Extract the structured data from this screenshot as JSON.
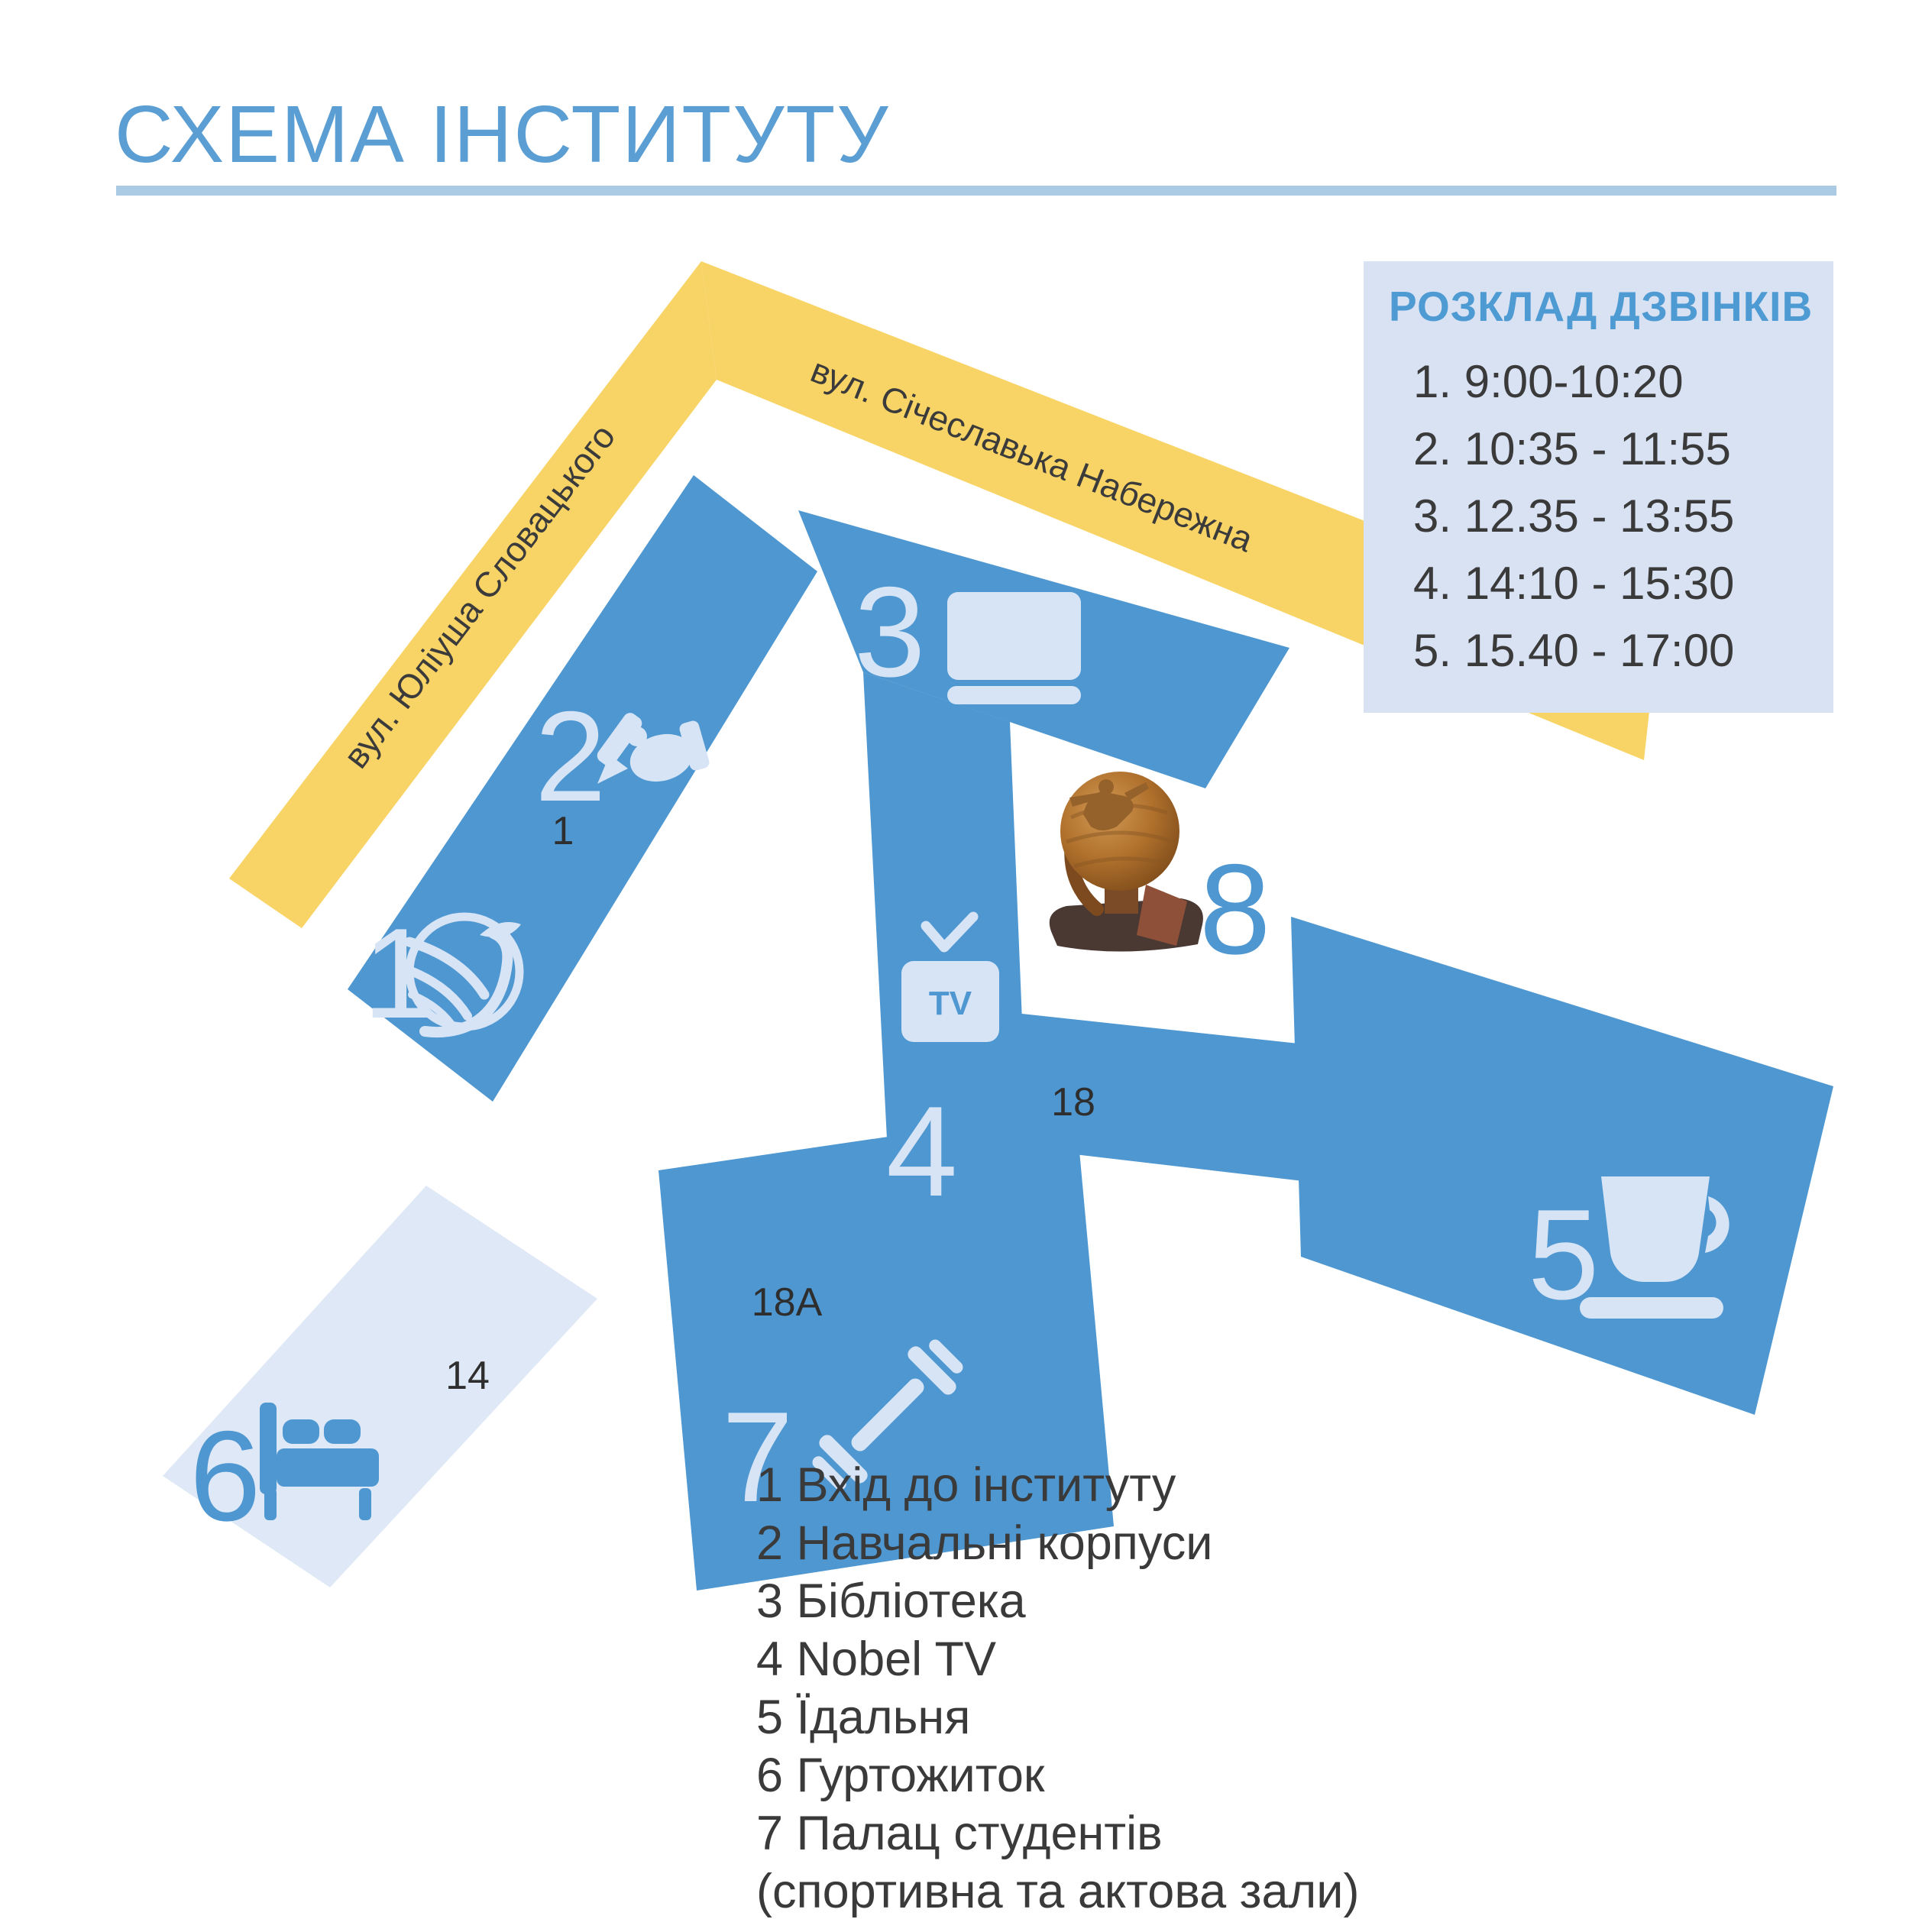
{
  "header": {
    "title": "СХЕМА ІНСТИТУТУ"
  },
  "streets": [
    {
      "name": "вул. Юліуша Словацького"
    },
    {
      "name": "вул. Січеславька Набережна"
    }
  ],
  "schedule": {
    "title": "РОЗКЛАД ДЗВІНКІВ",
    "items": [
      "1. 9:00-10:20",
      "2. 10:35 - 11:55",
      "3. 12.35 - 13:55",
      "4. 14:10 - 15:30",
      "5. 15.40 - 17:00"
    ]
  },
  "buildings": {
    "entrance": {
      "number": "1"
    },
    "academic": {
      "number": "2",
      "address": "1"
    },
    "library": {
      "number": "3"
    },
    "tv": {
      "number": "4",
      "screen_label": "TV"
    },
    "canteen": {
      "number": "5",
      "address": "18"
    },
    "dormitory": {
      "number": "6",
      "address": "14"
    },
    "palace": {
      "number": "7",
      "address": "18А"
    },
    "monument": {
      "number": "8"
    }
  },
  "legend": {
    "items": [
      "1 Вхід до інституту",
      "2 Навчальні корпуси",
      "3 Бібліотека",
      "4 Nobel TV",
      "5 Їдальня",
      "6 Гуртожиток",
      "7 Палац студентів",
      "(спортивна та актова зали)"
    ]
  },
  "colors": {
    "building_blue": "#4E97D1",
    "street_yellow": "#F8D466",
    "icon_light": "#D6E4F5",
    "panel_bg": "#D8E2F3",
    "dormitory_fill": "#DFE8F6",
    "accent_blue": "#5B9ED3",
    "text_dark": "#3A3A3A",
    "underline": "#ABCBE5"
  }
}
